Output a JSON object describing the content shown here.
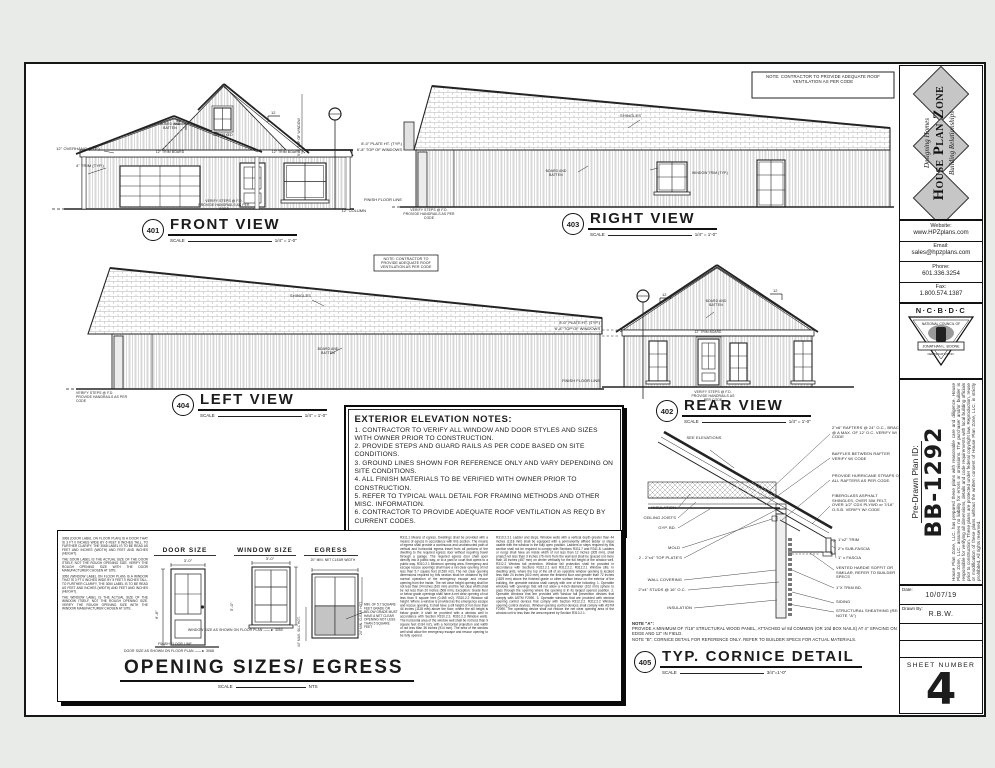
{
  "colors": {
    "page_bg": "#e9ebe9",
    "paper": "#ffffff",
    "ink": "#1c1c1c",
    "logo_diamond": "#c6c6c6",
    "egress_shaded": "#c4c4c4"
  },
  "scale_label": "SCALE",
  "roof_note": "NOTE: CONTRACTOR TO PROVIDE ADEQUATE ROOF VENTILATION AS PER CODE",
  "dims": {
    "plate": "8'-0\" PLATE HT. (TYP.)",
    "windows": "6'-8\" TOP OF WINDOWS",
    "ffl": "FINISH FLOOR LINE",
    "column": "12\" COLUMN"
  },
  "views": {
    "front": {
      "num": "401",
      "title": "FRONT VIEW",
      "scale": "1/4\" = 1'-0\"",
      "overhang": "12\" OVERHANG (TYP.)",
      "trim4": "4\" TRIM (TYP.)",
      "trim12_left": "12\" TRIM BOARD",
      "trim12_right": "12\" TRIM BOARD",
      "board_batten": "BOARD AND BATTEN",
      "gable_window": "2020 FIXED",
      "pitch": "12",
      "vert_dim": "9'-0\" TOP OF WINDOW",
      "steps": "VERIFY STEPS @ F.D. PROVIDE HANDRAILS AS PER CODE"
    },
    "right": {
      "num": "403",
      "title": "RIGHT VIEW",
      "scale": "1/4\" = 1'-0\"",
      "shingles": "SHINGLES",
      "board_batten": "BOARD AND BATTEN",
      "window_trim": "WINDOW TRIM (TYP.)",
      "steps": "VERIFY STEPS @ F.D. PROVIDE HANDRAILS AS PER CODE"
    },
    "left": {
      "num": "404",
      "title": "LEFT VIEW",
      "scale": "1/4\" = 1'-0\"",
      "shingles": "SHINGLES",
      "board_batten": "BOARD AND BATTEN",
      "steps": "VERIFY STEPS @ F.D. PROVIDE HANDRAILS AS PER CODE"
    },
    "rear": {
      "num": "402",
      "title": "REAR VIEW",
      "scale": "1/4\" = 1'-0\"",
      "trim12": "12\" TRIM BOARD",
      "board_batten": "BOARD AND BATTEN",
      "pitch": "12",
      "steps": "VERIFY STEPS @ F.D. PROVIDE HANDRAILS AS PER CODE"
    }
  },
  "elevation_notes": {
    "title": "EXTERIOR ELEVATION NOTES:",
    "items": [
      "1. CONTRACTOR TO VERIFY ALL WINDOW AND DOOR STYLES AND SIZES WITH OWNER PRIOR TO CONSTRUCTION.",
      "2. PROVIDE STEPS AND GUARD RAILS AS PER CODE BASED ON SITE CONDITIONS.",
      "3. GROUND LINES SHOWN FOR REFERENCE ONLY AND VARY DEPENDING ON SITE CONDITIONS.",
      "4. ALL FINISH MATERIALS TO BE VERIFIED WITH OWNER PRIOR TO CONSTRUCTION.",
      "5. REFER TO TYPICAL WALL DETAIL FOR FRAMING METHODS AND OTHER MISC. INFORMATION.",
      "6. CONTRACTOR TO PROVIDE ADEQUATE ROOF VENTILATION AS REQ'D BY CURRENT CODES."
    ]
  },
  "opening": {
    "title": "OPENING SIZES/ EGRESS",
    "scale": "NTS",
    "door_label": "DOOR SIZE",
    "window_label": "WINDOW SIZE",
    "egress_label": "EGRESS",
    "door_w": "3'-0\"",
    "door_h": "6'-8\"",
    "win_w": "3'-0\"",
    "win_h": "5'-0\"",
    "egress_w": "20\" MIN. NET CLEAR WIDTH",
    "egress_note": "MIN. OF 5.7 SQUARE FEET GRADE OR BELOW GRADE MUST HAVE A NET CLEAR OPENING NOT LESS THAN 5 SQUARE FEET",
    "sill": "44\" MAX. SILL HGT.",
    "clear_hgt": "24\" MIN. CLEAR HGT.",
    "ffl": "FINISH FLOOR LINE",
    "door_plan": "DOOR SIZE AS SHOWN ON FLOOR PLAN",
    "door_code": "3068",
    "win_plan": "WINDOW SIZE AS SHOWN ON FLOOR PLAN",
    "win_code": "3050",
    "left_notes": [
      "3068 (DOOR LABEL ON FLOOR PLAN) IS A DOOR THAT IS 3 FT 0 INCHES WIDE BY 6 FEET 8 INCHES TALL. TO FURTHER CLARIFY, THE 3068 LABEL IS TO BE READ AS FEET AND INCHES (WIDTH) AND FEET AND INCHES (HEIGHT).",
      "THE DOOR LABEL IS THE ACTUAL SIZE OF THE DOOR ITSELF, NOT THE ROUGH OPENING SIZE. VERIFY THE ROUGH OPENING SIZE WITH THE DOOR MANUFACTURER CHOSEN AT SITE.",
      "3050 (WINDOW LABEL ON FLOOR PLAN) IS A WINDOW THAT IS 3 FT 0 INCHES WIDE BY 5 FEET 0 INCHES TALL. TO FURTHER CLARIFY, THE 3050 LABEL IS TO BE READ AS FEET AND INCHES (WIDTH) AND FEET AND INCHES (HEIGHT).",
      "THE WINDOW LABEL IS THE ACTUAL SIZE OF THE WINDOW ITSELF, NOT THE ROUGH OPENING SIZE. VERIFY THE ROUGH OPENING SIZE WITH THE WINDOW MANUFACTURER CHOSEN AT SITE."
    ],
    "code_col1": "R311.1 Means of egress. Dwellings shall be provided with a means of egress in accordance with this section. The means of egress shall provide a continuous and unobstructed path of vertical and horizontal egress travel from all portions of the dwelling to the required egress door without requiring travel through a garage. The required egress door shall open directly into a public way, or to a yard or court that opens to a public way. R310.2.1 Minimum opening area. Emergency and escape rescue openings shall have a net clear opening of not less than 5.7 square feet (0.530 m2). The net clear opening dimensions required by this section shall be obtained by the normal operation of the emergency escape and rescue opening from the inside. The net clear height opening shall be not less than 24 inches (610 mm) and the net clear width shall be not less than 20 inches (508 mm). Exception: Grade floor or below grade openings shall have a net clear opening of not less than 5 square feet (0.465 m2). R310.2.2 Window sill height. Where a window is provided as the emergency escape and rescue opening, it shall have a sill height of not more than 44 inches (1118 mm) above the floor; where the sill height is below grade, it shall be provided with a window well in accordance with Section R310.2.3. R310.2.3 Window wells. The horizontal area of the window well shall be not less than 9 square feet (0.84 m2), with a horizontal projection and width of not less than 36 inches (914 mm). The area of the window well shall allow the emergency escape and rescue opening to be fully opened.",
    "code_col2": "R310.2.3.1 Ladder and steps. Window wells with a vertical depth greater than 44 inches (1118 mm) shall be equipped with a permanently affixed ladder or steps usable with the window in the fully open position. Ladders or steps required by this section shall not be required to comply with Sections R311.7 and R311.8. Ladders or rungs shall have an inside width of not less than 12 inches (305 mm), shall project not less than 3 inches (76 mm) from the wall and shall be spaced not more than 18 inches (457 mm) on center vertically for the full height of the window well. R312.2 Window fall protection. Window fall protection shall be provided in accordance with Sections R312.2.1 and R312.2.2. R312.2.1 Window sills. In dwelling units, where the top of the sill of an operable window opening is located less than 24 inches (610 mm) above the finished floor and greater than 72 inches (1829 mm) above the finished grade or other surface below on the exterior of the building, the operable window shall comply with one of the following: 1. Operable windows with openings that will not allow a 4-inch-diameter (102 mm) sphere to pass through the opening where the opening is in its largest opened position. 2. Operable windows that are provided with window fall prevention devices that comply with ASTM F2090. 3. Operable windows that are provided with window opening control devices that comply with Section R312.2.2. R312.2.2 Window opening control devices. Window opening control devices shall comply with ASTM F2090. The operating device shall not reduce the net clear opening area of the window unit to less than the area required by Section R310.2.1."
  },
  "cornice": {
    "num": "405",
    "title": "TYP. CORNICE DETAIL",
    "scale": "3/4\"=1'-0\"",
    "see_elev": "SEE ELEVATIONS",
    "left_labels": [
      "INSULATION",
      "CEILING JOISTS",
      "GYP. BD.",
      "MOLD",
      "2 - 2\"x4\" TOP PLATE'S",
      "WALL COVERING",
      "2\"x4\" STUDS @ 16\" O.C.",
      "INSULATION"
    ],
    "right_labels": [
      "2\"x6\" RAFTERS @ 24\" O.C., BRACE @ A MAX. OF 12' O.C. VERIFY W/ CODE",
      "BAFFLES BETWEEN RAFTER VERIFY W/ CODE",
      "PROVIDE HURRICANE STRAPS ON ALL RAFTERS AS PER CODE.",
      "FIBERGLASS ASPHALT SHINGLES, OVER 30# FELT, OVER 1/2\" CDX PLYWD or 7/16\" O.S.B. VERIFY W/ CODE",
      "1\"x2\" TRIM",
      "2\"x SUB-FASCIA",
      "1\" x FASCIA",
      "VENTED HARDIE SOFFIT OR SIMILAR, REFER TO BUILDER SPECS",
      "1\"X TRIM BD.",
      "SIDING",
      "STRUCTURAL SHEATHING (RE: NOTE \"A\")"
    ],
    "note_a_head": "NOTE \"A\":",
    "note_a": "PROVIDE A MINIMUM OF 7/16\" STRUCTURAL WOOD PANEL, ATTACHED w/ 8d COMMON (OR 10d BOX NAILS) AT 4\" SPACING ON EDGE AND 12\" IN FIELD.",
    "note_b": "NOTE \"B\": CORNICE DETAIL FOR REFERENCE ONLY. REFER TO BUILDER SPECS FOR ACTUAL MATERIALS."
  },
  "titleblock": {
    "logo": {
      "top": "Designing Homes",
      "main": "House Plan Zone",
      "bottom": "Building Relationships"
    },
    "website_label": "Website:",
    "website": "www.HPZplans.com",
    "email_label": "Email:",
    "email": "sales@hpzplans.com",
    "phone_label": "Phone:",
    "phone": "601.336.3254",
    "fax_label": "Fax:",
    "fax": "1.800.574.1387",
    "ncbdc": {
      "name_row": "N·C·B·D·C",
      "council": "NATIONAL COUNCIL OF",
      "member": "JONATHAN L. BOONE",
      "cert": "CERTIFICATION NO."
    },
    "plan_id_label": "Pre-Drawn Plan ID:",
    "plan_id": "BB-1292",
    "fine_print": "House Plan Zone, LLC. has prepared these plans with reasonable care and diligence. House Plan Zone, LLC. assumes no liability for errors or omissions. The purchaser and/or builder is responsible for verifying all dimensions, details and code requirements with local building officials prior to construction. These plans are protected under federal copyright law. Reproduction, reuse or modification of these plans without the written consent of House Plan Zone, LLC. is strictly prohibited. All rights reserved.",
    "date_label": "Date:",
    "date": "10/07/19",
    "drawn_label": "Drawn By:",
    "drawn": "R.B.W.",
    "sheet_label": "SHEET NUMBER",
    "sheet_number": "4"
  }
}
